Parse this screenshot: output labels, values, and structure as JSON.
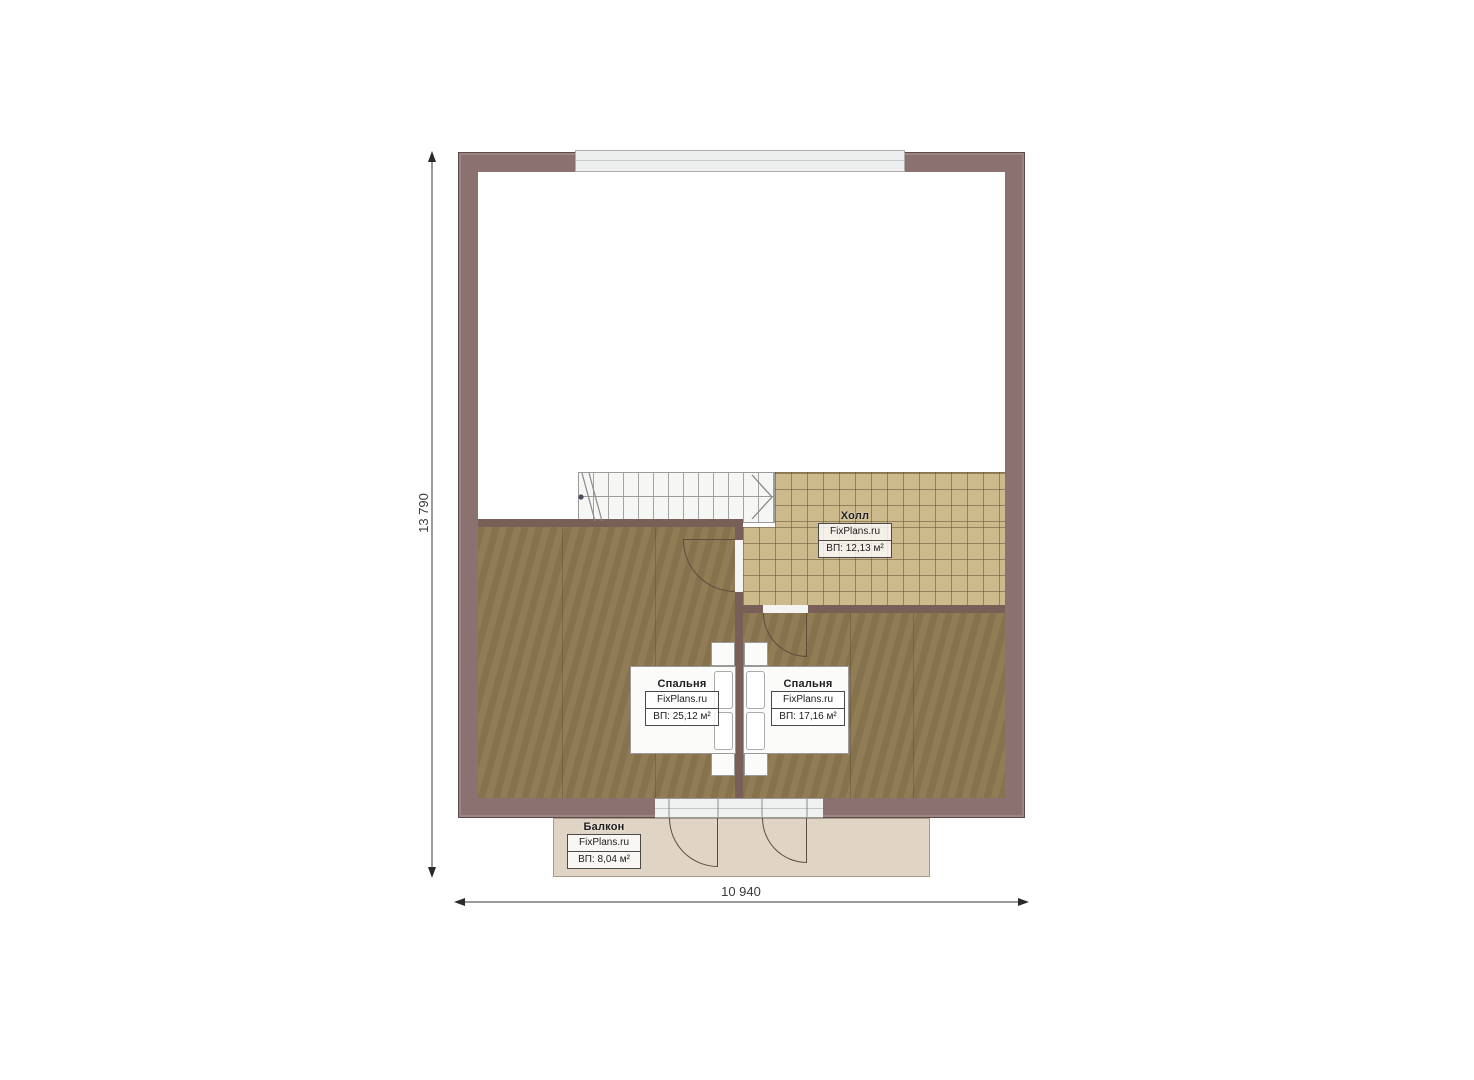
{
  "plan": {
    "watermark": "FixPlans.ru",
    "rooms": {
      "hall": {
        "name": "Холл",
        "area": "ВП: 12,13 м²"
      },
      "bedroom_left": {
        "name": "Спальня",
        "area": "ВП: 25,12 м²"
      },
      "bedroom_right": {
        "name": "Спальня",
        "area": "ВП: 17,16 м²"
      },
      "balcony": {
        "name": "Балкон",
        "area": "ВП: 8,04 м²"
      }
    },
    "dimensions": {
      "vertical": "13 790",
      "horizontal": "10 940"
    },
    "colors": {
      "wall": "#8b7270",
      "bedroom_floor": "#8c7850",
      "tile_floor": "#ccb98c",
      "balcony_floor": "#e0d5c4"
    }
  }
}
